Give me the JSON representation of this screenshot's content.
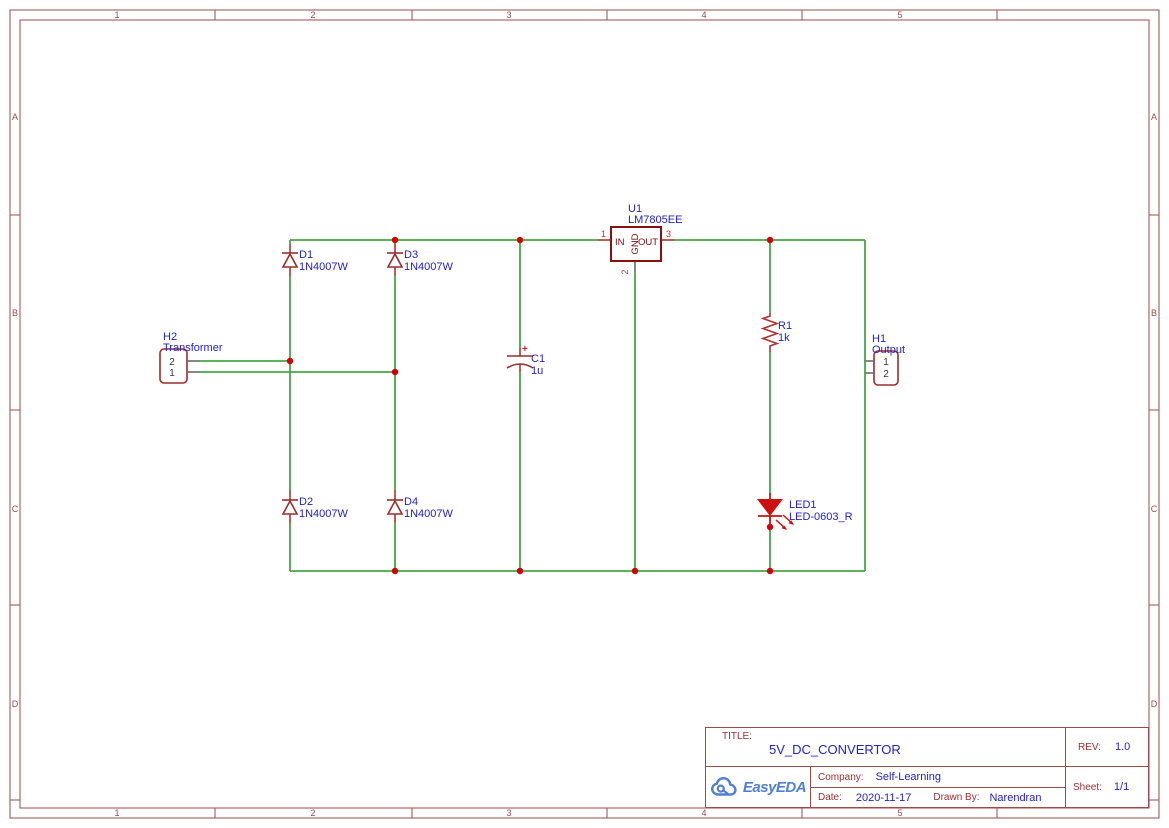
{
  "sheet": {
    "columns": [
      "1",
      "2",
      "3",
      "4",
      "5"
    ],
    "rows": [
      "A",
      "B",
      "C",
      "D"
    ]
  },
  "components": {
    "h2": {
      "ref": "H2",
      "value": "Transformer",
      "pin_top": "2",
      "pin_bottom": "1"
    },
    "h1": {
      "ref": "H1",
      "value": "Output",
      "pin_top": "1",
      "pin_bottom": "2"
    },
    "d1": {
      "ref": "D1",
      "value": "1N4007W"
    },
    "d2": {
      "ref": "D2",
      "value": "1N4007W"
    },
    "d3": {
      "ref": "D3",
      "value": "1N4007W"
    },
    "d4": {
      "ref": "D4",
      "value": "1N4007W"
    },
    "c1": {
      "ref": "C1",
      "value": "1u",
      "polarity": "+"
    },
    "u1": {
      "ref": "U1",
      "value": "LM7805EE",
      "pin1": "1",
      "pin2": "2",
      "pin3": "3",
      "pin_in": "IN",
      "pin_gnd": "GND",
      "pin_out": "OUT"
    },
    "r1": {
      "ref": "R1",
      "value": "1k"
    },
    "led1": {
      "ref": "LED1",
      "value": "LED-0603_R"
    }
  },
  "title_block": {
    "title_label": "TITLE:",
    "title": "5V_DC_CONVERTOR",
    "rev_label": "REV:",
    "rev": "1.0",
    "company_label": "Company:",
    "company": "Self-Learning",
    "sheet_label": "Sheet:",
    "sheet": "1/1",
    "date_label": "Date:",
    "date": "2020-11-17",
    "drawn_by_label": "Drawn By:",
    "drawn_by": "Narendran",
    "logo_text": "EasyEDA"
  },
  "colors": {
    "frame": "#9d4b4b",
    "wire_green": "#45a845",
    "junction_red": "#d00000",
    "component_dark_red": "#9b2d2d",
    "ic_outline": "#8c0f0f",
    "label_blue": "#2222cc",
    "pin_number_red": "#c03232",
    "led_red": "#cc1111",
    "logo_blue": "#4f7fd6"
  }
}
